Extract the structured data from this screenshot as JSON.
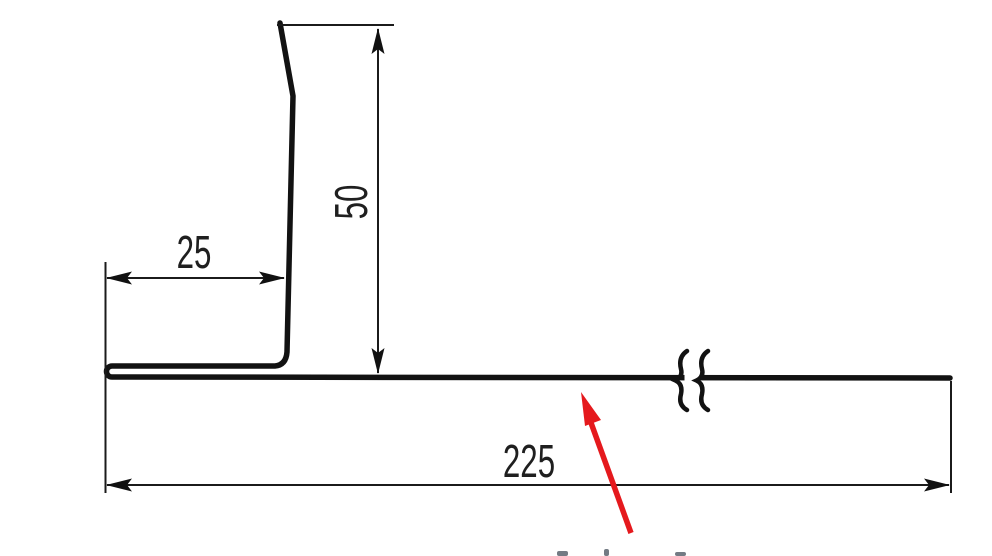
{
  "diagram": {
    "dimensions": {
      "flange_width": "25",
      "upstand_height": "50",
      "base_length": "225"
    },
    "colors": {
      "background": "#ffffff",
      "line": "#121212",
      "text": "#1f1f1f",
      "pointer": "#e5191d"
    }
  }
}
